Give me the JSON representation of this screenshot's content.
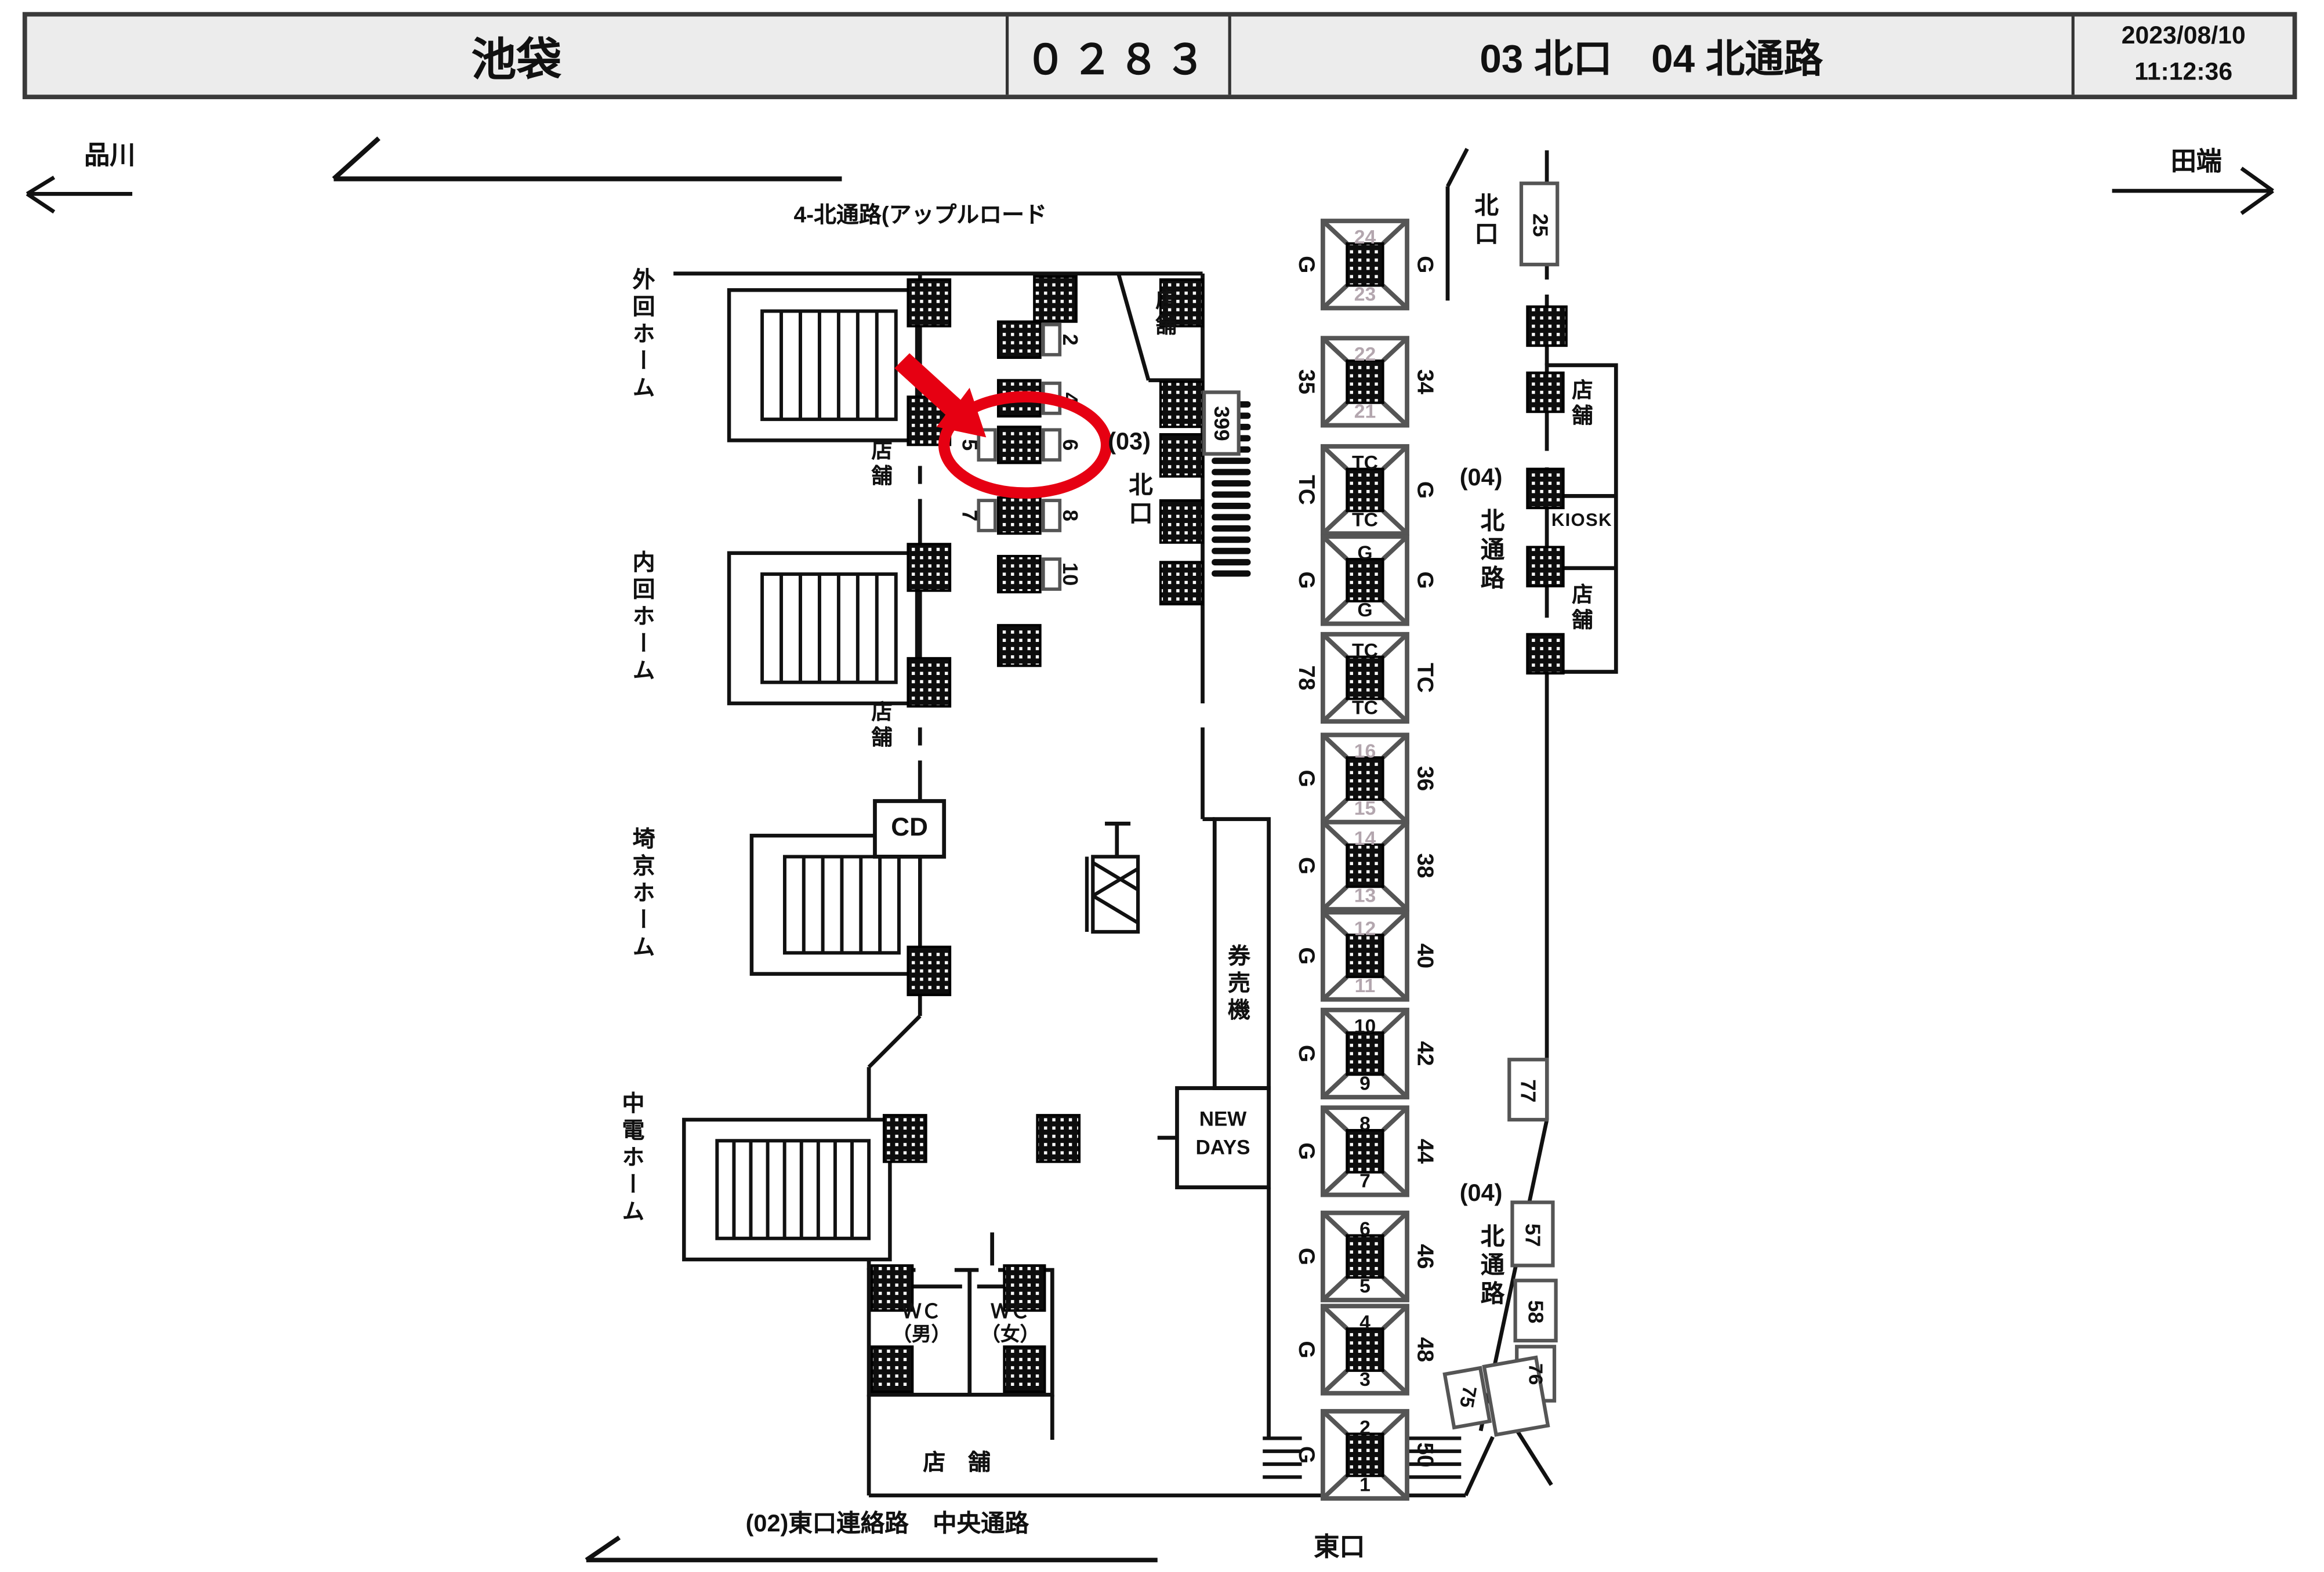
{
  "header": {
    "station": "池袋",
    "code": "０２８３",
    "section": "03 北口　04 北通路",
    "date": "2023/08/10",
    "time": "11:12:36"
  },
  "nav": {
    "left_station": "品川",
    "right_station": "田端",
    "top_route": "4-北通路(アップルロード",
    "bottom_route": "(02)東口連絡路　中央通路"
  },
  "platforms": [
    "外回ホーム",
    "内回ホーム",
    "埼京ホーム",
    "中電ホーム"
  ],
  "areas": {
    "gate03_num": "(03)",
    "gate03_name": "北口",
    "north_exit": "北口",
    "east_exit": "東口",
    "passage04_num": "(04)",
    "passage04_name": "北通路",
    "shop": "店舗",
    "bottom_shop": "店　舗",
    "cd": "CD",
    "kiosk": "KIOSK",
    "newdays_1": "NEW",
    "newdays_2": "DAYS",
    "ticket_machines": "券売機",
    "wc": "ＷＣ",
    "wc_male": "（男）",
    "wc_female": "（女）"
  },
  "corridor_boxes": [
    {
      "left": "",
      "right": "2"
    },
    {
      "left": "",
      "right": "4"
    },
    {
      "left": "5",
      "right": "6"
    },
    {
      "left": "7",
      "right": "8"
    },
    {
      "left": "",
      "right": "10"
    }
  ],
  "pillar_boxes": [
    {
      "top": "24",
      "bottom": "23",
      "left": "G",
      "right": "G",
      "dim": true
    },
    {
      "top": "22",
      "bottom": "21",
      "left": "35",
      "right": "34",
      "dim": true
    },
    {
      "top": "TC",
      "bottom": "TC",
      "left": "TC",
      "right": "G",
      "dim": false
    },
    {
      "top": "G",
      "bottom": "G",
      "left": "G",
      "right": "G",
      "dim": false
    },
    {
      "top": "TC",
      "bottom": "TC",
      "left": "78",
      "right": "TC",
      "dim": false
    },
    {
      "top": "16",
      "bottom": "15",
      "left": "G",
      "right": "36",
      "dim": true
    },
    {
      "top": "14",
      "bottom": "13",
      "left": "G",
      "right": "38",
      "dim": true
    },
    {
      "top": "12",
      "bottom": "11",
      "left": "G",
      "right": "40",
      "dim": true
    },
    {
      "top": "10",
      "bottom": "9",
      "left": "G",
      "right": "42",
      "dim": false
    },
    {
      "top": "8",
      "bottom": "7",
      "left": "G",
      "right": "44",
      "dim": false
    },
    {
      "top": "6",
      "bottom": "5",
      "left": "G",
      "right": "46",
      "dim": false
    },
    {
      "top": "4",
      "bottom": "3",
      "left": "G",
      "right": "48",
      "dim": false
    },
    {
      "top": "2",
      "bottom": "1",
      "left": "G",
      "right": "50",
      "dim": false
    }
  ],
  "wall_numbers": {
    "n399": "399",
    "n25": "25",
    "n77": "77",
    "n57": "57",
    "n58": "58",
    "n76": "76",
    "n75": "75"
  },
  "highlight": {
    "color": "#e60012",
    "circled_box": "5・6"
  },
  "colors": {
    "line": "#111111",
    "box_frame": "#555555",
    "dim_text": "#b3a6ae",
    "header_bg": "#ececec"
  }
}
